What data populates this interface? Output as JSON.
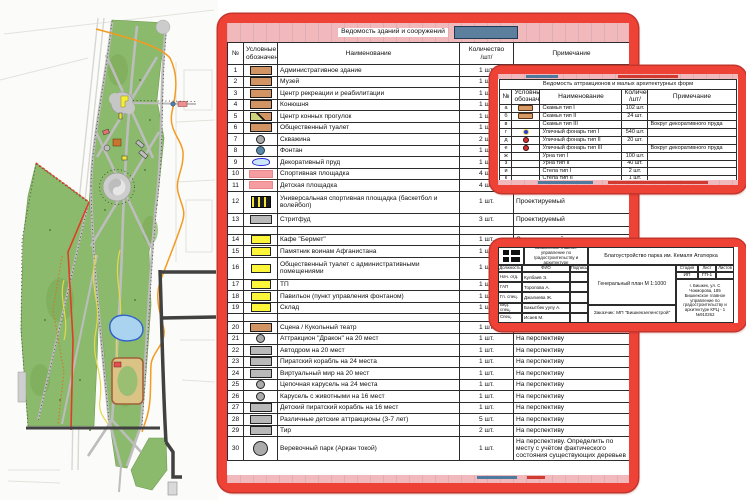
{
  "palette": {
    "annotation_red": "#ee4237",
    "sheet_pink": "#f2b9bd",
    "fragment_blue": "#5b7f9d",
    "park_green": "#8cba6d",
    "path_grey": "#bdbdbd",
    "route_orange": "#f49a20",
    "boundary_red": "#e23b27",
    "pond_blue": "#a9d3ee",
    "symbol_tan": "#d29463",
    "symbol_yellow": "#fdf53a",
    "symbol_pink": "#f59da1"
  },
  "buildings_table": {
    "title": "Ведомость зданий и сооружений",
    "col_num": "№",
    "col_symbol": "Условные обозначения",
    "col_name": "Наименование",
    "col_qty": "Количество",
    "col_qty2": "/шт/",
    "col_note": "Примечание",
    "rows": [
      {
        "num": "1",
        "sym": "tan",
        "name": "Административное здание",
        "qty": "1 шт.",
        "note": "Проектируемый"
      },
      {
        "num": "2",
        "sym": "tan",
        "name": "Музей",
        "qty": "1 шт.",
        "note": "Проектируемый"
      },
      {
        "num": "3",
        "sym": "tan",
        "name": "Центр рекреации и реабилитации",
        "qty": "1 шт.",
        "note": "Проектируемый"
      },
      {
        "num": "4",
        "sym": "tan",
        "name": "Конюшня",
        "qty": "1 шт.",
        "note": "Проектируемый"
      },
      {
        "num": "5",
        "sym": "tansplit",
        "name": "Центр конных прогулок",
        "qty": "1 шт.",
        "note": "Проектируемый"
      },
      {
        "num": "6",
        "sym": "tan",
        "name": "Общественный туалет",
        "qty": "1 шт.",
        "note": "Проектируемый"
      },
      {
        "num": "7",
        "sym": "circle",
        "name": "Скважина",
        "qty": "2 шт.",
        "note": "Проектируемый"
      },
      {
        "num": "8",
        "sym": "circle-blue",
        "name": "Фонтан",
        "qty": "1 шт.",
        "note": "Проектируемый"
      },
      {
        "num": "9",
        "sym": "pond",
        "name": "Декоративный пруд",
        "qty": "1 шт.",
        "note": "Проектируемый"
      },
      {
        "num": "10",
        "sym": "pink",
        "name": "Спортивная площадка",
        "qty": "4 шт.",
        "note": "Проектируемый"
      },
      {
        "num": "11",
        "sym": "pink",
        "name": "Детская площадка",
        "qty": "4 шт.",
        "note": "Проектируемый"
      },
      {
        "num": "12",
        "sym": "court",
        "name": "Универсальная спортивная площадка (баскетбол и волейбол)",
        "qty": "1 шт.",
        "note": "Проектируемый",
        "h": 22
      },
      {
        "num": "13",
        "sym": "grey",
        "name": "Стритфуд",
        "qty": "3 шт.",
        "note": "Проектируемый",
        "h": 13
      },
      {
        "spacer": true
      },
      {
        "num": "14",
        "sym": "yellow",
        "name": "Кафе \"Бермет\"",
        "qty": "1 шт.",
        "note": "Существующий"
      },
      {
        "num": "15",
        "sym": "yellow",
        "name": "Памятник воинам Афганистана",
        "qty": "1 шт.",
        "note": "Существующий"
      },
      {
        "num": "16",
        "sym": "yellow",
        "name": "Общественный туалет с административными помещениями",
        "qty": "1 шт.",
        "note": "Существующий",
        "h": 22
      },
      {
        "num": "17",
        "sym": "yellow",
        "name": "ТП",
        "qty": "1 шт.",
        "note": "Существующий"
      },
      {
        "num": "18",
        "sym": "yellow",
        "name": "Павильон (пункт управления фонтаном)",
        "qty": "1 шт.",
        "note": "Существующий"
      },
      {
        "num": "19",
        "sym": "yellow",
        "name": "Склад",
        "qty": "1 шт.",
        "note": "Существующий"
      },
      {
        "spacer": true
      },
      {
        "num": "20",
        "sym": "tan",
        "name": "Сцена / Кукольный театр",
        "qty": "1 шт.",
        "note": "На перспективу"
      },
      {
        "num": "21",
        "sym": "circle",
        "name": "Аттракцион \"Дракон\" на 20 мест",
        "qty": "1 шт.",
        "note": "На перспективу"
      },
      {
        "num": "22",
        "sym": "grey",
        "name": "Автодром на 20 мест",
        "qty": "1 шт.",
        "note": "На перспективу"
      },
      {
        "num": "23",
        "sym": "grey",
        "name": "Пиратский корабль на 24 места",
        "qty": "1 шт.",
        "note": "На перспективу"
      },
      {
        "num": "24",
        "sym": "grey",
        "name": "Виртуальный мир на 20 мест",
        "qty": "1 шт.",
        "note": "На перспективу"
      },
      {
        "num": "25",
        "sym": "circle",
        "name": "Цепочная карусель на 24 места",
        "qty": "1 шт.",
        "note": "На перспективу"
      },
      {
        "num": "26",
        "sym": "circle",
        "name": "Карусель с животными на 16 мест",
        "qty": "1 шт.",
        "note": "На перспективу"
      },
      {
        "num": "27",
        "sym": "grey",
        "name": "Детский пиратский корабль на 16 мест",
        "qty": "1 шт.",
        "note": "На перспективу"
      },
      {
        "num": "28",
        "sym": "grey",
        "name": "Различные детские аттракционы  (3-7 лет)",
        "qty": "5 шт.",
        "note": "На перспективу"
      },
      {
        "num": "29",
        "sym": "grey",
        "name": "Тир",
        "qty": "2 шт.",
        "note": "На перспективу"
      },
      {
        "num": "30",
        "sym": "circle-big",
        "name": "Веревочный парк (Аркан токой)",
        "qty": "1 шт.",
        "note": "На перспективу. Определить по месту с учётом фактического состояния существующих деревьев",
        "h": 24
      }
    ]
  },
  "attractions_table": {
    "title": "Ведомость аттракционов и малых архитектурных форм",
    "col_num": "№",
    "col_symbol": "Условные обозначения",
    "col_name": "Наименование",
    "col_qty": "Количество",
    "col_qty2": "/шт/",
    "col_note": "Примечание",
    "rows": [
      {
        "num": "а",
        "sym": "bench",
        "name": "Скамья тип I",
        "qty": "102 шт.",
        "note": ""
      },
      {
        "num": "б",
        "sym": "bench",
        "name": "Скамья тип II",
        "qty": "24 шт.",
        "note": ""
      },
      {
        "num": "в",
        "name": "Скамья тип III",
        "qty": "",
        "note": "Вокруг декоративного пруда"
      },
      {
        "num": "г",
        "sym": "dotblue",
        "name": "Уличный фонарь тип I",
        "qty": "540 шт.",
        "note": ""
      },
      {
        "num": "д",
        "sym": "dotred",
        "name": "Уличный фонарь тип II",
        "qty": "20 шт.",
        "note": ""
      },
      {
        "num": "е",
        "sym": "dotred",
        "name": "Уличный фонарь тип III",
        "qty": "",
        "note": "Вокруг декоративного пруда"
      },
      {
        "num": "ж",
        "name": "Урна тип I",
        "qty": "100 шт.",
        "note": ""
      },
      {
        "num": "з",
        "name": "Урна тип II",
        "qty": "40 шт.",
        "note": ""
      },
      {
        "num": "и",
        "name": "Стела тип I",
        "qty": "2 шт.",
        "note": ""
      },
      {
        "num": "к",
        "name": "Стела тип II",
        "qty": "1 шт.",
        "note": ""
      }
    ]
  },
  "stamp": {
    "org": "Бишкекское главное управление по градостроительству и архитектуре",
    "project": "Благоустройство парка им. Кемаля Ататюрка",
    "col_role": "Должность",
    "col_name": "ФИО",
    "col_sign": "Подпись",
    "people": [
      {
        "role": "Нач. отд.",
        "name": "Кулбаев Э."
      },
      {
        "role": "ГАП",
        "name": "Торопова А."
      },
      {
        "role": "Гл. спец.",
        "name": "Джалиева Ж."
      },
      {
        "role": "Вед. спец.",
        "name": "Бакытбек уулу А."
      },
      {
        "role": "Спец.",
        "name": "Исаев М."
      }
    ],
    "drawing": "Генеральный план М 1:1000",
    "client": "Заказчик: МП \"Бишкекзеленстрой\"",
    "col_stage": "Стадия",
    "col_sheet": "Лист",
    "col_sheets": "Листов",
    "stage": "ИП",
    "sheet": "ГП-1",
    "sheets": "",
    "address": "г. Бишкек, ул. С Чокморова, 185 Бишкекское главное управление по градостроительству и архитектуре КРЦ - 1 №910262"
  }
}
